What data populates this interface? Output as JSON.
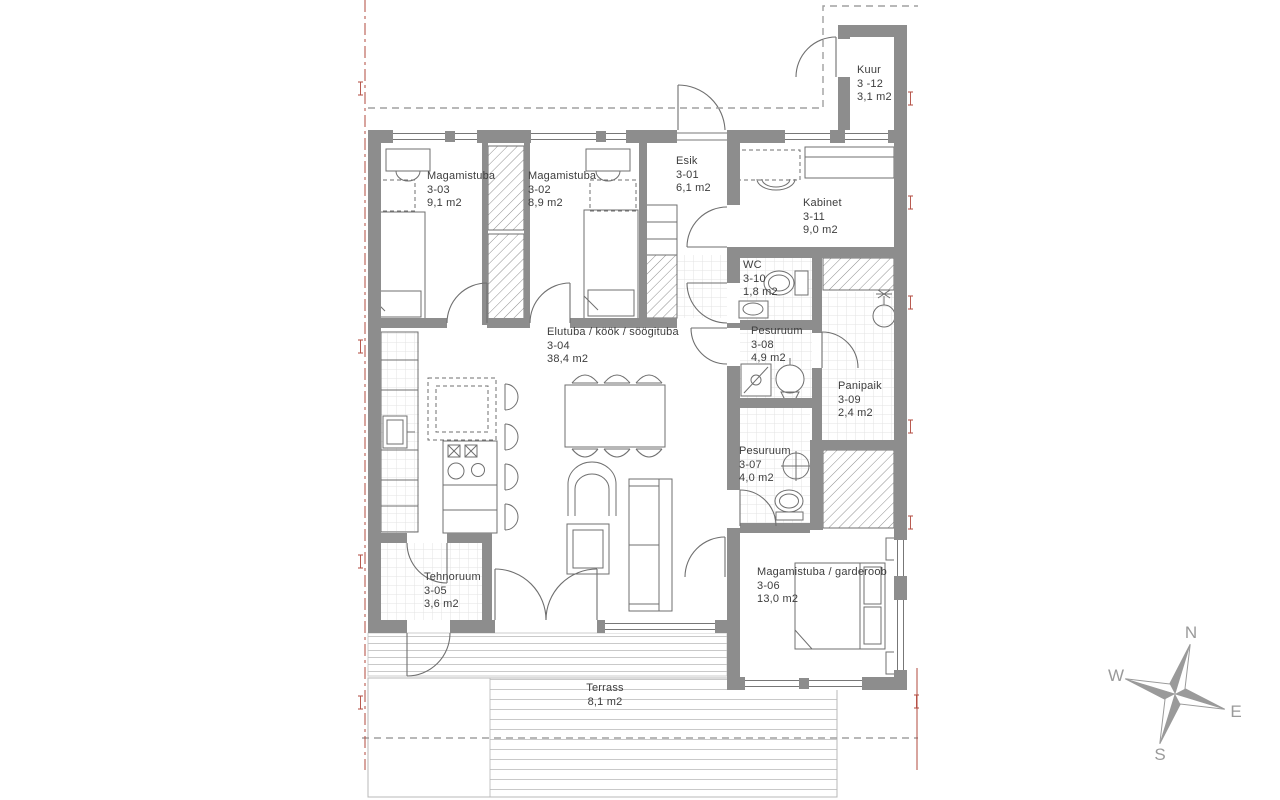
{
  "plan_title": "Apartment 3 floor plan",
  "rooms": [
    {
      "id": "esik-3-01",
      "name": "Esik",
      "number": "3-01",
      "area": "6,1 m2"
    },
    {
      "id": "magamistuba-3-02",
      "name": "Magamistuba",
      "number": "3-02",
      "area": "8,9 m2"
    },
    {
      "id": "magamistuba-3-03",
      "name": "Magamistuba",
      "number": "3-03",
      "area": "9,1 m2"
    },
    {
      "id": "elutuba-kook-soogituba-3-04",
      "name": "Elutuba / köök / söögituba",
      "number": "3-04",
      "area": "38,4 m2"
    },
    {
      "id": "tehnoruum-3-05",
      "name": "Tehnoruum",
      "number": "3-05",
      "area": "3,6 m2"
    },
    {
      "id": "magamistuba-garderoob-3-06",
      "name": "Magamistuba / garderoob",
      "number": "3-06",
      "area": "13,0 m2"
    },
    {
      "id": "pesuruum-3-07",
      "name": "Pesuruum",
      "number": "3-07",
      "area": "4,0 m2"
    },
    {
      "id": "pesuruum-3-08",
      "name": "Pesuruum",
      "number": "3-08",
      "area": "4,9 m2"
    },
    {
      "id": "panipaik-3-09",
      "name": "Panipaik",
      "number": "3-09",
      "area": "2,4 m2"
    },
    {
      "id": "wc-3-10",
      "name": "WC",
      "number": "3-10",
      "area": "1,8 m2"
    },
    {
      "id": "kabinet-3-11",
      "name": "Kabinet",
      "number": "3-11",
      "area": "9,0 m2"
    },
    {
      "id": "kuur-3-12",
      "name": "Kuur",
      "number": "3 -12",
      "area": "3,1 m2"
    }
  ],
  "terrace": {
    "name": "Terrass",
    "area": "8,1 m2"
  },
  "compass": {
    "north": "N",
    "west": "W",
    "east": "E",
    "south": "S"
  },
  "colors": {
    "wall": "#8d8d8d",
    "line": "#6f6f6f",
    "dashed_boundary": "#a0a0a0",
    "survey_red": "#b2493e",
    "deck_stripe": "#c9c9c9",
    "compass_gray": "#9a9a9a",
    "text": "#3d3d3d"
  }
}
